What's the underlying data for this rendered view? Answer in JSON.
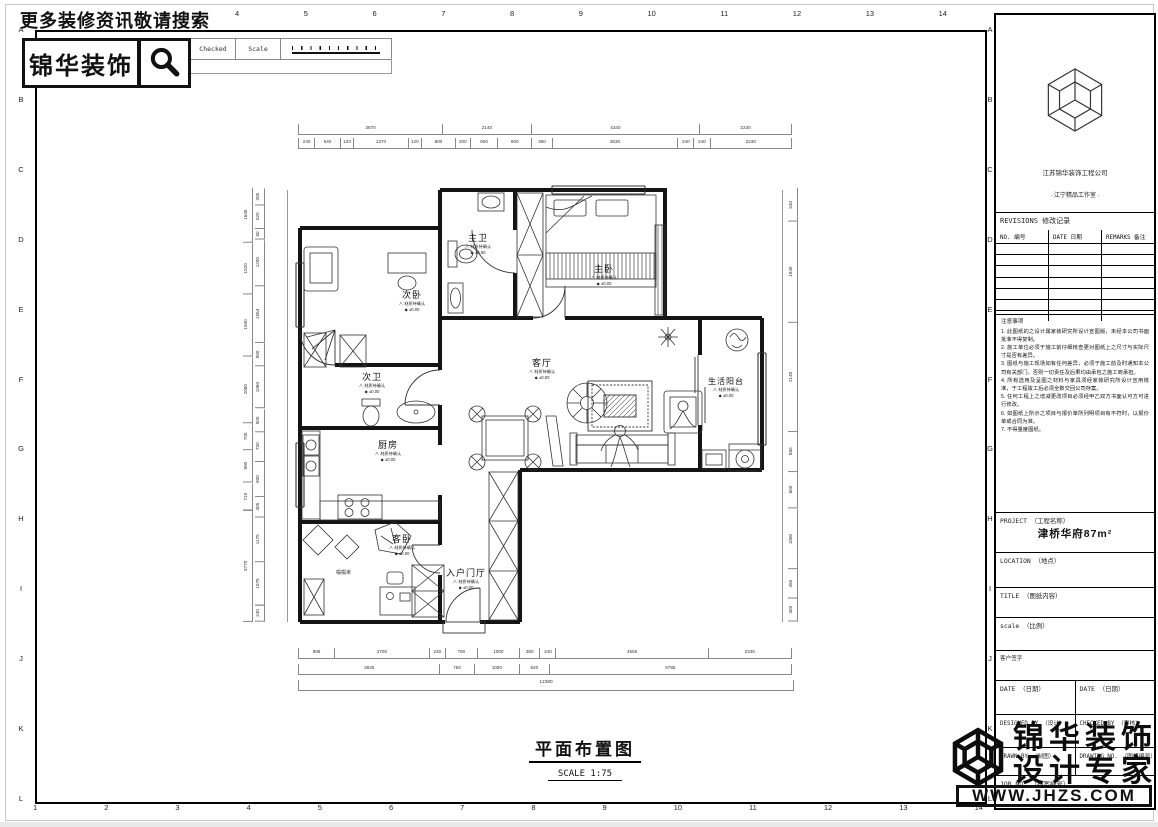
{
  "overlay": {
    "promo_text": "更多装修资讯敬请搜索",
    "brand_name": "锦华装饰",
    "watermark": {
      "line1": "锦华装饰",
      "line2": "设计专家",
      "url": "WWW.JHZS.COM"
    }
  },
  "header_strip": {
    "signature": "Signature",
    "checked": "Checked",
    "scale": "Scale"
  },
  "ruler": {
    "top": [
      "4",
      "5",
      "6",
      "7",
      "8",
      "9",
      "10",
      "11",
      "12",
      "13",
      "14"
    ],
    "bottom": [
      "1",
      "2",
      "3",
      "4",
      "5",
      "6",
      "7",
      "8",
      "9",
      "10",
      "11",
      "12",
      "13",
      "14"
    ],
    "left": [
      "A",
      "B",
      "C",
      "D",
      "E",
      "F",
      "G",
      "H",
      "I",
      "J",
      "K",
      "L"
    ],
    "right": [
      "A",
      "B",
      "C",
      "D",
      "E",
      "F",
      "G",
      "H",
      "I",
      "J",
      "K",
      "L"
    ]
  },
  "title_block": {
    "company": "江苏锦华装饰工程公司",
    "studio": "· 江宁精品工作室 ·",
    "revisions_title": "REVISIONS 修改记录",
    "rev_no": "NO. 编号",
    "rev_date": "DATE 日期",
    "rev_remarks": "REMARKS 备注",
    "notes_title": "注意事项",
    "notes": [
      "1. 此图纸的之设计属家装研究所设计宣图版，未经本公司书面批准不得复制。",
      "2. 施工单位必须于施工前仔细核查更对图纸上之尺寸与实际尺寸是否有差异。",
      "3. 图纸与施工现场如有任何差异，必须于施工前及时通知本公司有关部门，否则一切责任及后果均由承包之施工商承担。",
      "4. 所有选用及呈图之材料与家具须经家装研究所设计宣用核准，于工程竣工后必须全数交回公司存案。",
      "5. 任何工程上之增减更改项目必须经甲乙双方书面认可方可进行修改。",
      "6. 如图纸上所示之项目与报价单所列明项目有不符时，以报价单或合同为准。",
      "7. 不得量度图纸。"
    ],
    "project_label": "PROJECT （工程名称）",
    "project_value": "津桥华府87m²",
    "location_label": "LOCATION （地点）",
    "title_label": "TITLE （图纸内容）",
    "scale_label": "scale （比例）",
    "client_sign": "客户签字",
    "date_left": "DATE （日期）",
    "date_right": "DATE （日期）",
    "designed_by": "DESIGNED BY （设计）",
    "checked_by": "CHECKED BY （审核）",
    "drawn_by": "DRAWN BY （制图）",
    "drawing_no": "DRAWING NO. （图纸编号）",
    "job_no": "JOB NO. （档案编号）"
  },
  "plan": {
    "caption": "平面布置图",
    "caption_scale": "SCALE 1:75",
    "tatami": "榻榻米",
    "rooms": [
      {
        "name": "主卫",
        "material": "∧ 材质待确认",
        "level": "◆ ±0.00"
      },
      {
        "name": "主卧",
        "material": "∧ 材质待确认",
        "level": "◆ ±0.00"
      },
      {
        "name": "次卧",
        "material": "∧ 材质待确认",
        "level": "◆ ±0.00"
      },
      {
        "name": "次卫",
        "material": "∧ 材质待确认",
        "level": "◆ ±0.00"
      },
      {
        "name": "厨房",
        "material": "∧ 材质待确认",
        "level": "◆ ±0.00"
      },
      {
        "name": "客厅",
        "material": "∧ 材质待确认",
        "level": "◆ ±0.00"
      },
      {
        "name": "生活阳台",
        "material": "∧ 材质待确认",
        "level": "◆ ±0.00"
      },
      {
        "name": "客卧",
        "material": "∧ 材质待确认",
        "level": "◆ ±0.00"
      },
      {
        "name": "入户门厅",
        "material": "∧ 材质待确认",
        "level": "◆ ±0.00"
      }
    ]
  },
  "dims": {
    "top1": [
      "3670",
      "2140",
      "4340",
      "2230"
    ],
    "top2": [
      "240",
      "540",
      "120",
      "1370",
      "120",
      "800",
      "200",
      "600",
      "800",
      "380",
      "3630",
      "240",
      "240",
      "2230"
    ],
    "bottom1": [
      "885",
      "2700",
      "240",
      "750",
      "1000",
      "380",
      "240",
      "4555",
      "2330"
    ],
    "bottom2": [
      "3825",
      "750",
      "1000",
      "620",
      "6785"
    ],
    "total": "12380",
    "left_outer": [
      "1645",
      "1520",
      "1940",
      "2080",
      "700",
      "900",
      "710",
      "3770"
    ],
    "left_inner": [
      "300",
      "525",
      "60",
      "1200",
      "1564",
      "500",
      "1060",
      "500",
      "730",
      "900",
      "405",
      "1175",
      "1075",
      "240"
    ],
    "right1": [
      "540",
      "1940",
      "2140",
      "680",
      "600",
      "1060",
      "450",
      "300"
    ]
  }
}
